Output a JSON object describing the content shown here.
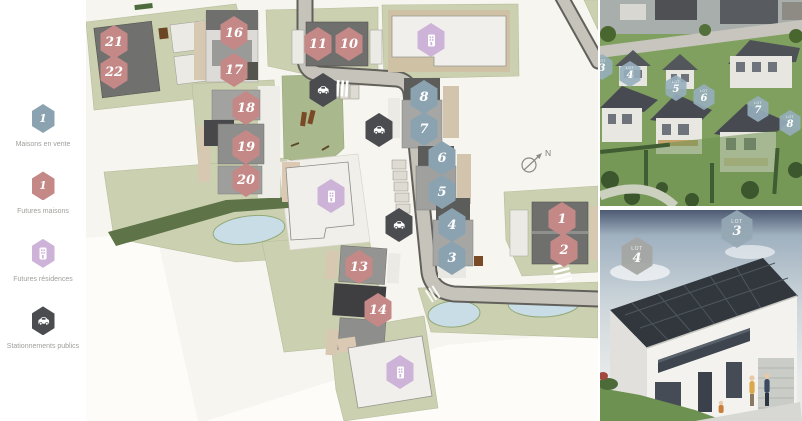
{
  "legend": {
    "items": [
      {
        "label": "Maisons en vente",
        "type": "sale",
        "glyph": "1",
        "color": "#8ba3b1"
      },
      {
        "label": "Futures maisons",
        "type": "future",
        "glyph": "1",
        "color": "#c48987"
      },
      {
        "label": "Futures résidences",
        "type": "residence",
        "glyph": "building-icon",
        "color": "#cdb3d8"
      },
      {
        "label": "Stationnements publics",
        "type": "parking",
        "glyph": "car-icon",
        "color": "#4b4c50"
      }
    ]
  },
  "map": {
    "north_label": "N",
    "markers": [
      {
        "lot": "21",
        "type": "future",
        "x": 28,
        "y": 42
      },
      {
        "lot": "22",
        "type": "future",
        "x": 28,
        "y": 72
      },
      {
        "lot": "16",
        "type": "future",
        "x": 148,
        "y": 33
      },
      {
        "lot": "17",
        "type": "future",
        "x": 148,
        "y": 70
      },
      {
        "lot": "11",
        "type": "future",
        "x": 232,
        "y": 44
      },
      {
        "lot": "10",
        "type": "future",
        "x": 263,
        "y": 44
      },
      {
        "lot": "18",
        "type": "future",
        "x": 160,
        "y": 108
      },
      {
        "lot": "19",
        "type": "future",
        "x": 160,
        "y": 147
      },
      {
        "lot": "20",
        "type": "future",
        "x": 160,
        "y": 180
      },
      {
        "lot": "8",
        "type": "sale",
        "x": 338,
        "y": 97
      },
      {
        "lot": "7",
        "type": "sale",
        "x": 338,
        "y": 129
      },
      {
        "lot": "6",
        "type": "sale",
        "x": 356,
        "y": 158
      },
      {
        "lot": "5",
        "type": "sale",
        "x": 356,
        "y": 192
      },
      {
        "lot": "4",
        "type": "sale",
        "x": 366,
        "y": 225
      },
      {
        "lot": "3",
        "type": "sale",
        "x": 366,
        "y": 258
      },
      {
        "lot": "13",
        "type": "future",
        "x": 273,
        "y": 267
      },
      {
        "lot": "14",
        "type": "future",
        "x": 292,
        "y": 310
      },
      {
        "lot": "1",
        "type": "future",
        "x": 476,
        "y": 219
      },
      {
        "lot": "2",
        "type": "future",
        "x": 478,
        "y": 250
      },
      {
        "type": "residence",
        "x": 345,
        "y": 40
      },
      {
        "type": "residence",
        "x": 245,
        "y": 196
      },
      {
        "type": "residence",
        "x": 314,
        "y": 372
      },
      {
        "type": "parking",
        "x": 237,
        "y": 90
      },
      {
        "type": "parking",
        "x": 293,
        "y": 130
      },
      {
        "type": "parking",
        "x": 313,
        "y": 225
      }
    ]
  },
  "photos": {
    "aerial": {
      "markers": [
        {
          "label": "LOT",
          "number": "3",
          "x": 2,
          "y": 67
        },
        {
          "label": "LOT",
          "number": "4",
          "x": 30,
          "y": 74
        },
        {
          "label": "LOT",
          "number": "5",
          "x": 76,
          "y": 88
        },
        {
          "label": "LOT",
          "number": "6",
          "x": 104,
          "y": 97
        },
        {
          "label": "LOT",
          "number": "7",
          "x": 158,
          "y": 109
        },
        {
          "label": "LOT",
          "number": "8",
          "x": 190,
          "y": 123
        }
      ]
    },
    "house": {
      "markers": [
        {
          "label": "LOT",
          "number": "4",
          "x": 37,
          "y": 46,
          "variant": "gray"
        },
        {
          "label": "LOT",
          "number": "3",
          "x": 137,
          "y": 19,
          "variant": "blue"
        }
      ]
    }
  },
  "colors": {
    "sale": "#8ba3b1",
    "future": "#c48987",
    "residence": "#cdb3d8",
    "parking": "#4b4c50",
    "parcel_green": "#cbd1b0",
    "park_green": "#a9b98d",
    "pond_blue": "#c9dde6",
    "road": "#c6c3bb"
  }
}
